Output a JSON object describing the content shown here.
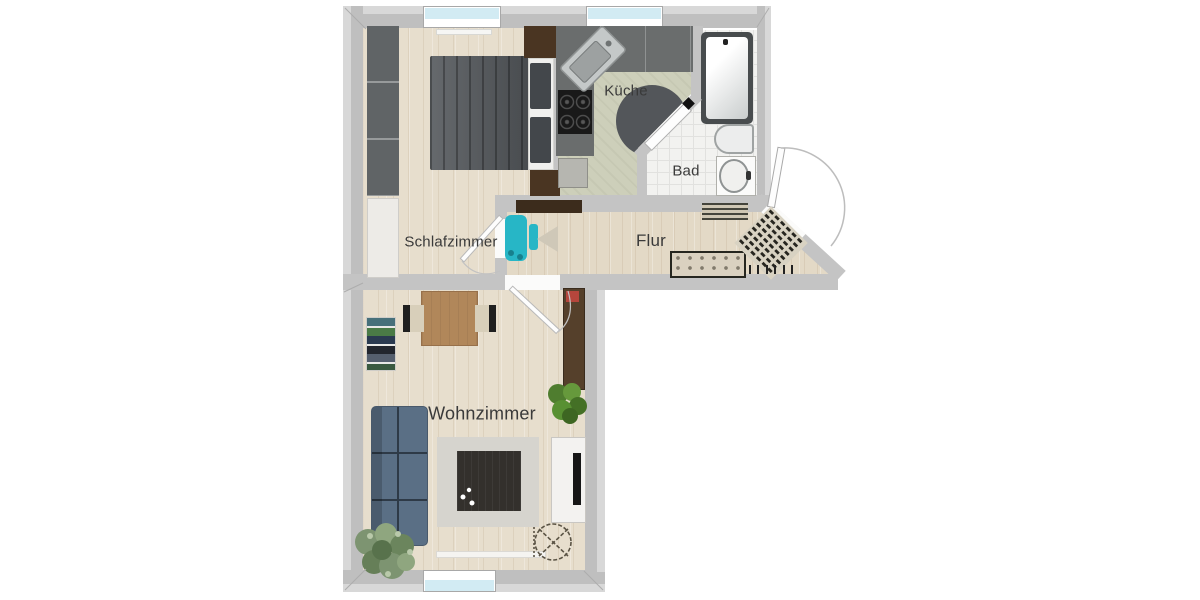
{
  "rooms": {
    "bedroom": {
      "label": "Schlafzimmer"
    },
    "kitchen": {
      "label": "Küche"
    },
    "bathroom": {
      "label": "Bad"
    },
    "hallway": {
      "label": "Flur"
    },
    "living_room": {
      "label": "Wohnzimmer"
    }
  },
  "colors": {
    "wall": "#c4c4c4",
    "wood_floor": "#e7decd",
    "kitchen_floor": "#cdcfba",
    "tile_floor": "#f2f2f0",
    "window_glass": "#d2ebf3",
    "bed": "#54585c",
    "sofa": "#5a6f85",
    "accent_teal": "#27b6c6",
    "wood_furniture": "#b1875a",
    "dark_wood": "#55402b",
    "plant_green": "#4f7d2f",
    "red_accent": "#b5463c"
  },
  "icons": {
    "bedroom": [
      "wardrobe",
      "double-bed",
      "pillows",
      "dresser",
      "bedside-cabinet",
      "side-table",
      "radiator"
    ],
    "kitchen": [
      "kitchen-counter",
      "sink",
      "cooktop",
      "corner-table",
      "appliance"
    ],
    "bathroom": [
      "bathtub",
      "toilet",
      "washbasin"
    ],
    "hallway": [
      "wall-sideboard",
      "stroller",
      "doormat",
      "entrance-mat",
      "bench",
      "coat-hooks",
      "entrance-door"
    ],
    "living_room": [
      "dining-table",
      "chair",
      "bookshelf",
      "sofa",
      "rug",
      "coffee-table",
      "plant",
      "tall-cabinet",
      "tv-sideboard",
      "ceiling-fan-symbol",
      "radiator"
    ]
  }
}
